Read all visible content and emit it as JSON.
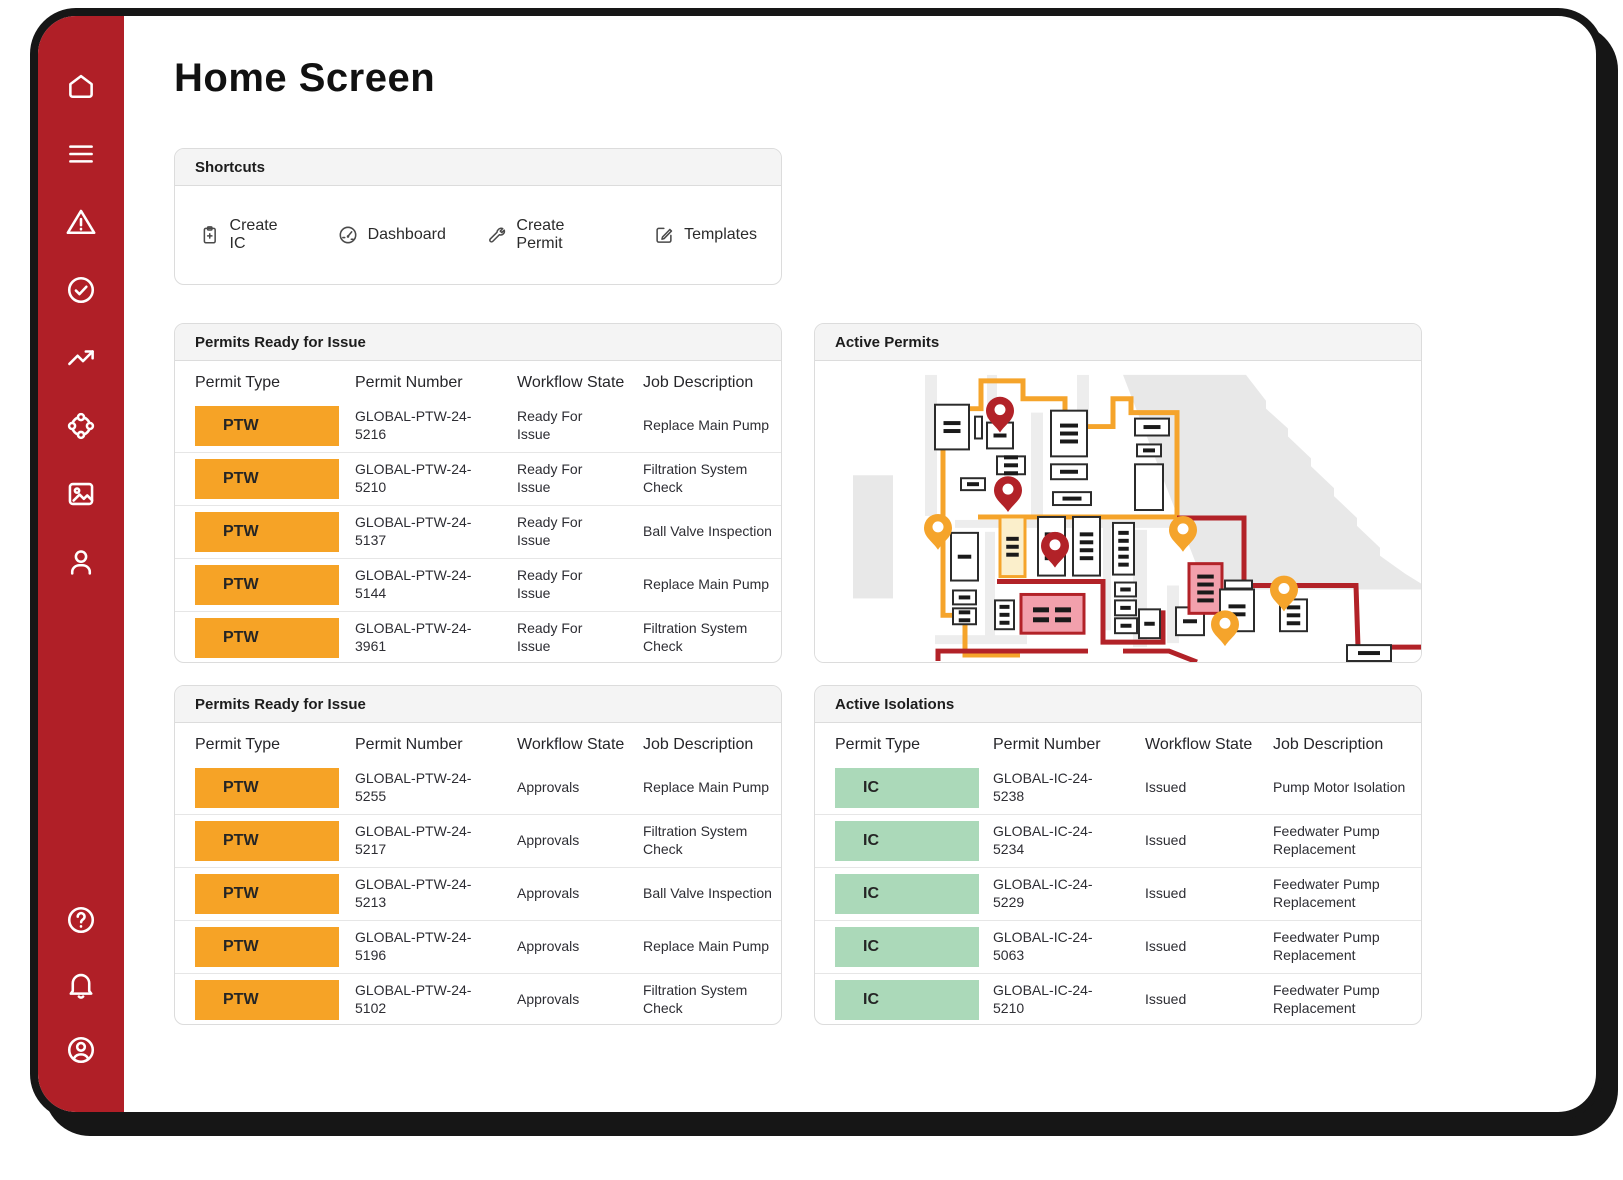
{
  "page": {
    "title": "Home Screen"
  },
  "sidebar": {
    "bg": "#B01F27",
    "items_top": [
      "home",
      "menu",
      "alert-triangle",
      "check-circle",
      "trending-up",
      "hub",
      "image",
      "user"
    ],
    "items_bottom": [
      "help-circle",
      "bell",
      "account-circle"
    ]
  },
  "shortcuts": {
    "title": "Shortcuts",
    "items": [
      {
        "icon": "clipboard-plus-icon",
        "label": "Create IC"
      },
      {
        "icon": "gauge-icon",
        "label": "Dashboard"
      },
      {
        "icon": "wrench-icon",
        "label": "Create Permit"
      },
      {
        "icon": "edit-square-icon",
        "label": "Templates"
      }
    ]
  },
  "tables": {
    "columns": [
      "Permit Type",
      "Permit Number",
      "Workflow State",
      "Job Description"
    ],
    "permits_ready_1": {
      "title": "Permits Ready for Issue",
      "badge": {
        "label": "PTW",
        "bg": "#F6A326"
      },
      "rows": [
        {
          "number": "GLOBAL-PTW-24-5216",
          "state": "Ready For Issue",
          "desc": "Replace Main Pump"
        },
        {
          "number": "GLOBAL-PTW-24-5210",
          "state": "Ready For Issue",
          "desc": "Filtration System Check"
        },
        {
          "number": "GLOBAL-PTW-24-5137",
          "state": "Ready For Issue",
          "desc": "Ball Valve Inspection"
        },
        {
          "number": "GLOBAL-PTW-24-5144",
          "state": "Ready For Issue",
          "desc": "Replace Main Pump"
        },
        {
          "number": "GLOBAL-PTW-24-3961",
          "state": "Ready For Issue",
          "desc": "Filtration System Check"
        }
      ]
    },
    "permits_ready_2": {
      "title": "Permits Ready for Issue",
      "badge": {
        "label": "PTW",
        "bg": "#F6A326"
      },
      "rows": [
        {
          "number": "GLOBAL-PTW-24-5255",
          "state": "Approvals",
          "desc": "Replace Main Pump"
        },
        {
          "number": "GLOBAL-PTW-24-5217",
          "state": "Approvals",
          "desc": "Filtration System Check"
        },
        {
          "number": "GLOBAL-PTW-24-5213",
          "state": "Approvals",
          "desc": "Ball Valve Inspection"
        },
        {
          "number": "GLOBAL-PTW-24-5196",
          "state": "Approvals",
          "desc": "Replace Main Pump"
        },
        {
          "number": "GLOBAL-PTW-24-5102",
          "state": "Approvals",
          "desc": "Filtration System Check"
        }
      ]
    },
    "active_isolations": {
      "title": "Active Isolations",
      "badge": {
        "label": "IC",
        "bg": "#ABD9B9"
      },
      "rows": [
        {
          "number": "GLOBAL-IC-24-5238",
          "state": "Issued",
          "desc": "Pump Motor Isolation"
        },
        {
          "number": "GLOBAL-IC-24-5234",
          "state": "Issued",
          "desc": "Feedwater Pump Replacement"
        },
        {
          "number": "GLOBAL-IC-24-5229",
          "state": "Issued",
          "desc": "Feedwater Pump Replacement"
        },
        {
          "number": "GLOBAL-IC-24-5063",
          "state": "Issued",
          "desc": "Feedwater Pump Replacement"
        },
        {
          "number": "GLOBAL-IC-24-5210",
          "state": "Issued",
          "desc": "Feedwater Pump Replacement"
        }
      ]
    }
  },
  "map_card": {
    "title": "Active Permits",
    "map": {
      "viewbox": "0 0 606 303",
      "colors": {
        "terrain": "#e8e8e8",
        "road": "#ededed",
        "orange": "#F5A42B",
        "red": "#B22228",
        "pink": "#F2A0AC",
        "yellow": "#FBEFCB",
        "building_fill": "#ffffff",
        "building_stroke": "#2b2b2b",
        "dash": "#1a1a1a"
      },
      "terrain": [
        {
          "type": "rect",
          "x": 38,
          "y": 115,
          "w": 40,
          "h": 124
        },
        {
          "type": "path",
          "d": "M308,14 H431 L451,40 L451,48 L473,68 L473,76 L496,98 L496,106 L519,128 L519,136 L542,158 L542,166 L565,188 L565,196 L590,214 L606,224 L606,230 L391,230 Z"
        }
      ],
      "roads": [
        [
          110,
          14,
          12,
          142
        ],
        [
          172,
          14,
          10,
          44
        ],
        [
          216,
          52,
          12,
          104
        ],
        [
          262,
          14,
          12,
          50
        ],
        [
          140,
          160,
          228,
          8
        ],
        [
          170,
          172,
          10,
          112
        ],
        [
          288,
          163,
          8,
          108
        ],
        [
          318,
          170,
          14,
          118
        ],
        [
          120,
          276,
          92,
          9
        ],
        [
          352,
          226,
          12,
          58
        ]
      ],
      "boundaries": [
        {
          "color": "orange",
          "d": "M128,158 L128,48 L166,48 L166,20 L208,20 L208,38 L250,38 L250,66 L298,66 L298,38 L316,38 L316,52 L362,52 L362,157 L163,157"
        },
        {
          "color": "orange",
          "d": "M128,155 L128,256 L150,256 L150,296 L205,296"
        },
        {
          "color": "red",
          "d": "M362,158 L429,158 L429,226 L541,226 L543,288 L606,288"
        },
        {
          "color": "red",
          "d": "M182,222 L288,222 L288,283 L348,283 L348,251"
        },
        {
          "color": "red",
          "d": "M123,302 L123,292 L273,292"
        },
        {
          "color": "red",
          "d": "M308,292 L354,292 L382,303"
        }
      ],
      "buildings": [
        {
          "x": 120,
          "y": 44,
          "w": 34,
          "h": 45,
          "fill": "w",
          "d": 2
        },
        {
          "x": 160,
          "y": 56,
          "w": 7,
          "h": 22,
          "fill": "w",
          "d": 0
        },
        {
          "x": 172,
          "y": 62,
          "w": 26,
          "h": 26,
          "fill": "w",
          "d": 1
        },
        {
          "x": 182,
          "y": 96,
          "w": 28,
          "h": 18,
          "fill": "w",
          "d": 3
        },
        {
          "x": 146,
          "y": 118,
          "w": 24,
          "h": 12,
          "fill": "w",
          "d": 1
        },
        {
          "x": 236,
          "y": 50,
          "w": 36,
          "h": 46,
          "fill": "w",
          "d": 3
        },
        {
          "x": 236,
          "y": 104,
          "w": 36,
          "h": 15,
          "fill": "w",
          "d": 1
        },
        {
          "x": 238,
          "y": 132,
          "w": 38,
          "h": 13,
          "fill": "w",
          "d": 1
        },
        {
          "x": 320,
          "y": 58,
          "w": 34,
          "h": 17,
          "fill": "w",
          "d": 1
        },
        {
          "x": 322,
          "y": 84,
          "w": 24,
          "h": 12,
          "fill": "w",
          "d": 1
        },
        {
          "x": 320,
          "y": 104,
          "w": 28,
          "h": 46,
          "fill": "w",
          "d": 0
        },
        {
          "x": 136,
          "y": 173,
          "w": 27,
          "h": 48,
          "fill": "w",
          "d": 1
        },
        {
          "x": 185,
          "y": 157,
          "w": 25,
          "h": 60,
          "fill": "y",
          "d": 3
        },
        {
          "x": 223,
          "y": 157,
          "w": 27,
          "h": 59,
          "fill": "w",
          "d": 4
        },
        {
          "x": 258,
          "y": 157,
          "w": 27,
          "h": 59,
          "fill": "w",
          "d": 4
        },
        {
          "x": 298,
          "y": 163,
          "w": 21,
          "h": 52,
          "fill": "w",
          "d": 5
        },
        {
          "x": 300,
          "y": 223,
          "w": 21,
          "h": 14,
          "fill": "w",
          "d": 1
        },
        {
          "x": 300,
          "y": 241,
          "w": 21,
          "h": 15,
          "fill": "w",
          "d": 1
        },
        {
          "x": 300,
          "y": 259,
          "w": 22,
          "h": 15,
          "fill": "w",
          "d": 1
        },
        {
          "x": 324,
          "y": 250,
          "w": 21,
          "h": 29,
          "fill": "w",
          "d": 1
        },
        {
          "x": 138,
          "y": 231,
          "w": 23,
          "h": 14,
          "fill": "w",
          "d": 1
        },
        {
          "x": 138,
          "y": 249,
          "w": 23,
          "h": 16,
          "fill": "w",
          "d": 2
        },
        {
          "x": 180,
          "y": 241,
          "w": 19,
          "h": 29,
          "fill": "w",
          "d": 3
        },
        {
          "x": 206,
          "y": 235,
          "w": 63,
          "h": 39,
          "fill": "p",
          "d": "eq"
        },
        {
          "x": 361,
          "y": 248,
          "w": 28,
          "h": 28,
          "fill": "w",
          "d": 1
        },
        {
          "x": 374,
          "y": 204,
          "w": 33,
          "h": 50,
          "fill": "p",
          "d": 4
        },
        {
          "x": 410,
          "y": 221,
          "w": 27,
          "h": 8,
          "fill": "w",
          "d": 0
        },
        {
          "x": 405,
          "y": 230,
          "w": 34,
          "h": 42,
          "fill": "w",
          "d": 2
        },
        {
          "x": 465,
          "y": 240,
          "w": 27,
          "h": 32,
          "fill": "w",
          "d": 3
        },
        {
          "x": 532,
          "y": 286,
          "w": 44,
          "h": 16,
          "fill": "w",
          "d": 1
        }
      ],
      "pins": [
        {
          "color": "orange",
          "x": 123,
          "y": 168
        },
        {
          "color": "orange",
          "x": 368,
          "y": 170
        },
        {
          "color": "orange",
          "x": 469,
          "y": 230
        },
        {
          "color": "orange",
          "x": 410,
          "y": 265
        },
        {
          "color": "red",
          "x": 185,
          "y": 50
        },
        {
          "color": "red",
          "x": 193,
          "y": 130
        },
        {
          "color": "red",
          "x": 240,
          "y": 186
        }
      ]
    }
  }
}
